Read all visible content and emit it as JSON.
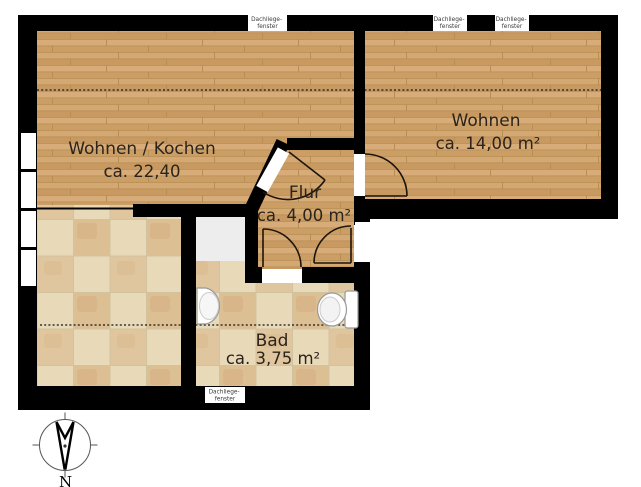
{
  "plan": {
    "rooms": [
      {
        "name": "Wohnen / Kochen",
        "area": "ca. 22,40"
      },
      {
        "name": "Wohnen",
        "area": "ca. 14,00 m²"
      },
      {
        "name": "Flur",
        "area": "ca. 4,00 m²"
      },
      {
        "name": "Bad",
        "area": "ca. 3,75 m²"
      }
    ],
    "skylight_label": {
      "line1": "Dachliege-",
      "line2": "fenster"
    },
    "skylight_count": 4,
    "compass": {
      "label": "N"
    },
    "colors": {
      "wall": "#000000",
      "wood": "#cfa26b",
      "wood_seam": "#b98e53",
      "tile": "#e8dab8",
      "tile_accent": "#ddbf94",
      "shower": "#ededed",
      "label_text": "#2b241c",
      "door_line": "#1d140b",
      "fixture_stroke": "#999999"
    }
  }
}
